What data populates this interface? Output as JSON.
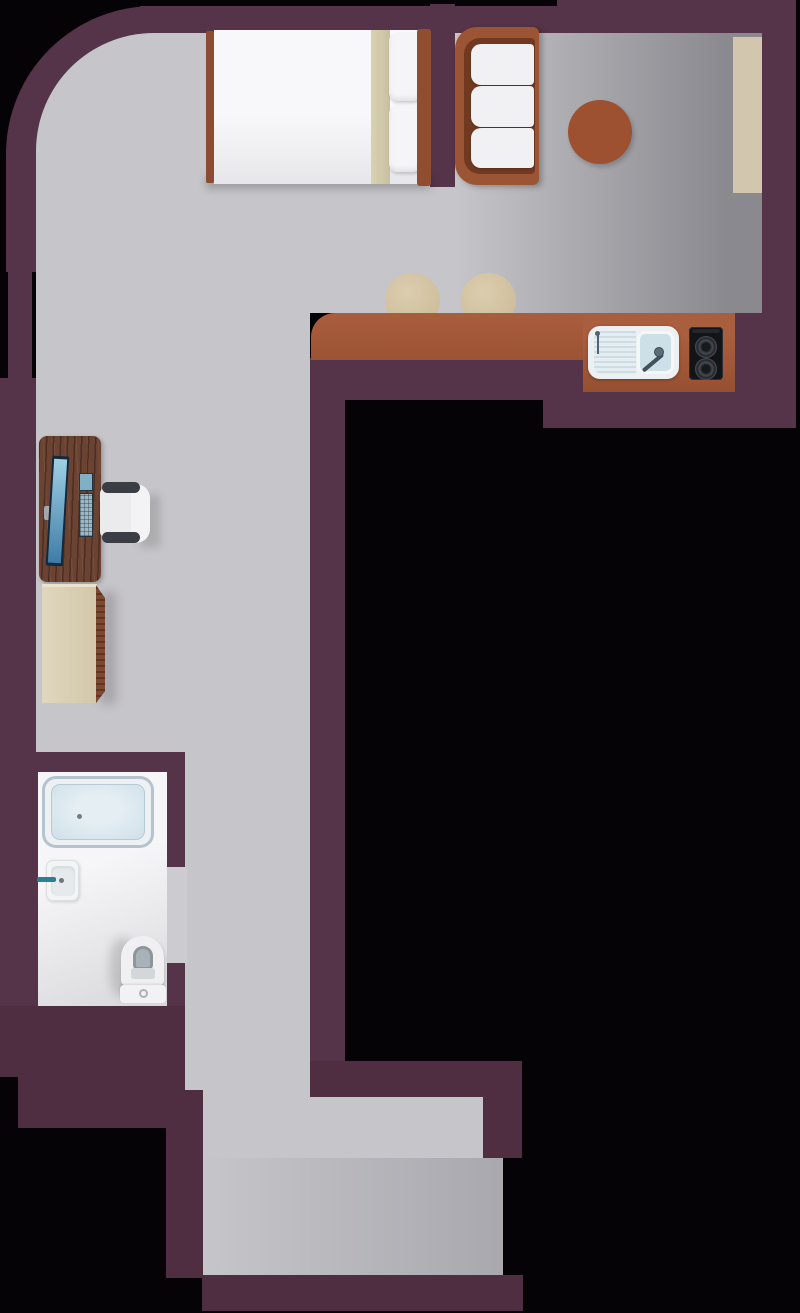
{
  "palette": {
    "bg": "#050305",
    "wall": "#553348",
    "wall2": "#4f2e42",
    "floor": "#c6c5c9",
    "bath_floor": "#f4f3f5",
    "counter": "#9c5334",
    "counter_dark": "#965031",
    "wood": "#6b4333",
    "wood_edge": "#7d4830",
    "sofa": "#9c5534",
    "sofa_inner": "#713a20",
    "table": "#9d5130",
    "beige": "#d2c6ae",
    "stool": "#c9b995",
    "cushion": "#f1f0f3",
    "basin": "#cde0e8",
    "tub_ring": "#b5c3cf",
    "tub_inner": "#cfe0e9",
    "steel": "#41525c",
    "stove": "#121417",
    "teal": "#2f7e95",
    "screen_hi": "#9fd0e4",
    "screen_lo": "#3f7ca6"
  },
  "floorplan": {
    "type": "studio-apartment-top-view",
    "rooms": [
      {
        "name": "sleeping-living-area",
        "features": [
          "curved-top-left-wall",
          "window-ledge-right"
        ]
      },
      {
        "name": "kitchen",
        "features": [
          "counter",
          "sink",
          "stove",
          "bar-stools"
        ]
      },
      {
        "name": "desk-nook"
      },
      {
        "name": "bathroom",
        "features": [
          "door-opening-right"
        ]
      },
      {
        "name": "corridor"
      },
      {
        "name": "entry-room-bottom"
      }
    ],
    "furniture": [
      {
        "name": "double-bed",
        "parts": {
          "pillows": 2,
          "blanket_fold": 1,
          "headboard": 1,
          "footboard": 1
        }
      },
      {
        "name": "sofa",
        "cushions": 3
      },
      {
        "name": "round-side-table"
      },
      {
        "name": "window-ledge"
      },
      {
        "name": "kitchen-counter"
      },
      {
        "name": "kitchen-sink",
        "parts": [
          "drainboard",
          "basin",
          "faucet"
        ]
      },
      {
        "name": "stove",
        "burners": 2
      },
      {
        "name": "bar-stool",
        "count": 2
      },
      {
        "name": "desk"
      },
      {
        "name": "monitor"
      },
      {
        "name": "keyboard"
      },
      {
        "name": "office-chair",
        "armrests": 2
      },
      {
        "name": "cabinet"
      },
      {
        "name": "bathtub",
        "drain": 1
      },
      {
        "name": "bathroom-sink",
        "faucet": 1
      },
      {
        "name": "toilet",
        "flush_button": 1
      }
    ]
  }
}
